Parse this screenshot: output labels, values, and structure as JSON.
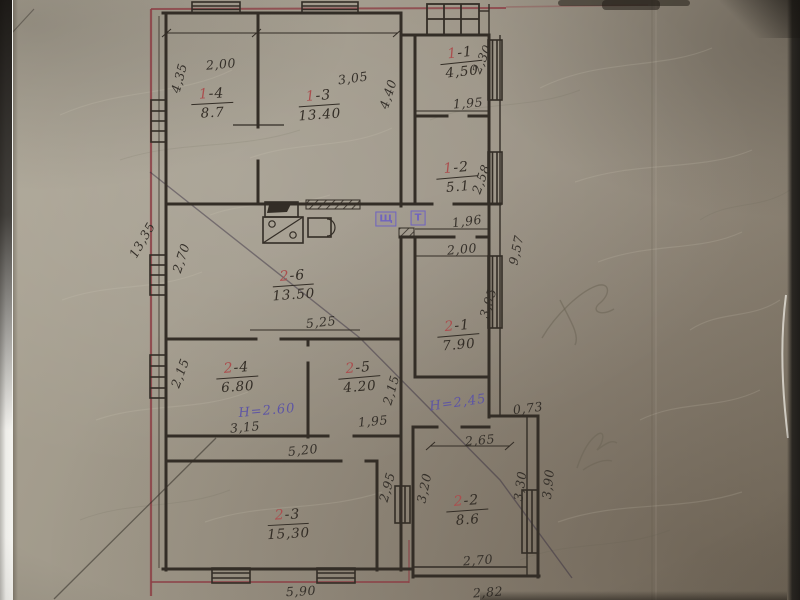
{
  "rooms": [
    {
      "number_prefix": "1",
      "number_suffix": "-4",
      "area": "8.7",
      "x": 212,
      "y": 102,
      "rot": -3
    },
    {
      "number_prefix": "1",
      "number_suffix": "-3",
      "area": "13.40",
      "x": 319,
      "y": 104,
      "rot": -4
    },
    {
      "number_prefix": "1",
      "number_suffix": "-1",
      "area": "4,50",
      "x": 461,
      "y": 61,
      "rot": -6
    },
    {
      "number_prefix": "1",
      "number_suffix": "-2",
      "area": "5.1",
      "x": 457,
      "y": 176,
      "rot": -5
    },
    {
      "number_prefix": "2",
      "number_suffix": "-6",
      "area": "13.50",
      "x": 293,
      "y": 284,
      "rot": -4
    },
    {
      "number_prefix": "2",
      "number_suffix": "-1",
      "area": "7.90",
      "x": 458,
      "y": 334,
      "rot": -5
    },
    {
      "number_prefix": "2",
      "number_suffix": "-4",
      "area": "6.80",
      "x": 237,
      "y": 376,
      "rot": -4
    },
    {
      "number_prefix": "2",
      "number_suffix": "-5",
      "area": "4.20",
      "x": 359,
      "y": 376,
      "rot": -5
    },
    {
      "number_prefix": "2",
      "number_suffix": "-3",
      "area": "15,30",
      "x": 288,
      "y": 523,
      "rot": -3
    },
    {
      "number_prefix": "2",
      "number_suffix": "-2",
      "area": "8.6",
      "x": 467,
      "y": 509,
      "rot": -4
    }
  ],
  "dimensions": [
    {
      "text": "2,00",
      "x": 221,
      "y": 64,
      "rot": -5
    },
    {
      "text": "3,05",
      "x": 353,
      "y": 78,
      "rot": -8
    },
    {
      "text": "4,35",
      "x": 179,
      "y": 78,
      "rot": -75
    },
    {
      "text": "4,40",
      "x": 388,
      "y": 94,
      "rot": -72
    },
    {
      "text": "2,30",
      "x": 482,
      "y": 59,
      "rot": -66
    },
    {
      "text": "1,95",
      "x": 468,
      "y": 103,
      "rot": -4
    },
    {
      "text": "2,58",
      "x": 481,
      "y": 179,
      "rot": -70
    },
    {
      "text": "1,96",
      "x": 467,
      "y": 221,
      "rot": -7
    },
    {
      "text": "2,00",
      "x": 462,
      "y": 249,
      "rot": -5
    },
    {
      "text": "9,57",
      "x": 516,
      "y": 250,
      "rot": -78
    },
    {
      "text": "13,35",
      "x": 142,
      "y": 240,
      "rot": -60
    },
    {
      "text": "2,70",
      "x": 181,
      "y": 258,
      "rot": -72
    },
    {
      "text": "5,25",
      "x": 321,
      "y": 322,
      "rot": -6
    },
    {
      "text": "3,95",
      "x": 488,
      "y": 303,
      "rot": -73
    },
    {
      "text": "2,15",
      "x": 180,
      "y": 373,
      "rot": -70
    },
    {
      "text": "2,15",
      "x": 391,
      "y": 390,
      "rot": -74
    },
    {
      "text": "3,15",
      "x": 245,
      "y": 427,
      "rot": -5
    },
    {
      "text": "1,95",
      "x": 373,
      "y": 421,
      "rot": -5
    },
    {
      "text": "5,20",
      "x": 303,
      "y": 450,
      "rot": -6
    },
    {
      "text": "2,95",
      "x": 387,
      "y": 487,
      "rot": -75
    },
    {
      "text": "5,90",
      "x": 301,
      "y": 591,
      "rot": -3
    },
    {
      "text": "0,73",
      "x": 528,
      "y": 408,
      "rot": -7
    },
    {
      "text": "2,65",
      "x": 480,
      "y": 440,
      "rot": -5
    },
    {
      "text": "3,20",
      "x": 424,
      "y": 488,
      "rot": -78
    },
    {
      "text": "3,30",
      "x": 520,
      "y": 486,
      "rot": -82
    },
    {
      "text": "3,90",
      "x": 548,
      "y": 484,
      "rot": -84
    },
    {
      "text": "2,70",
      "x": 478,
      "y": 560,
      "rot": -4
    },
    {
      "text": "2,82",
      "x": 488,
      "y": 592,
      "rot": -4
    }
  ],
  "height_notes": [
    {
      "text": "Н=2.60",
      "x": 267,
      "y": 411,
      "rot": -5
    },
    {
      "text": "Н=2,45",
      "x": 458,
      "y": 403,
      "rot": -8
    }
  ],
  "stamps": [
    {
      "text": "Щ",
      "x": 386,
      "y": 219
    },
    {
      "text": "Т",
      "x": 418,
      "y": 218
    }
  ],
  "colors": {
    "ink": "#332d26",
    "red_boundary_line": "#8c3f45",
    "red_room_number": "#ab4e4e",
    "purple_ink": "#5d55a5",
    "stamp_purple": "#6f63c0",
    "paper": "#9a9284",
    "pencil": "#6b6455"
  }
}
